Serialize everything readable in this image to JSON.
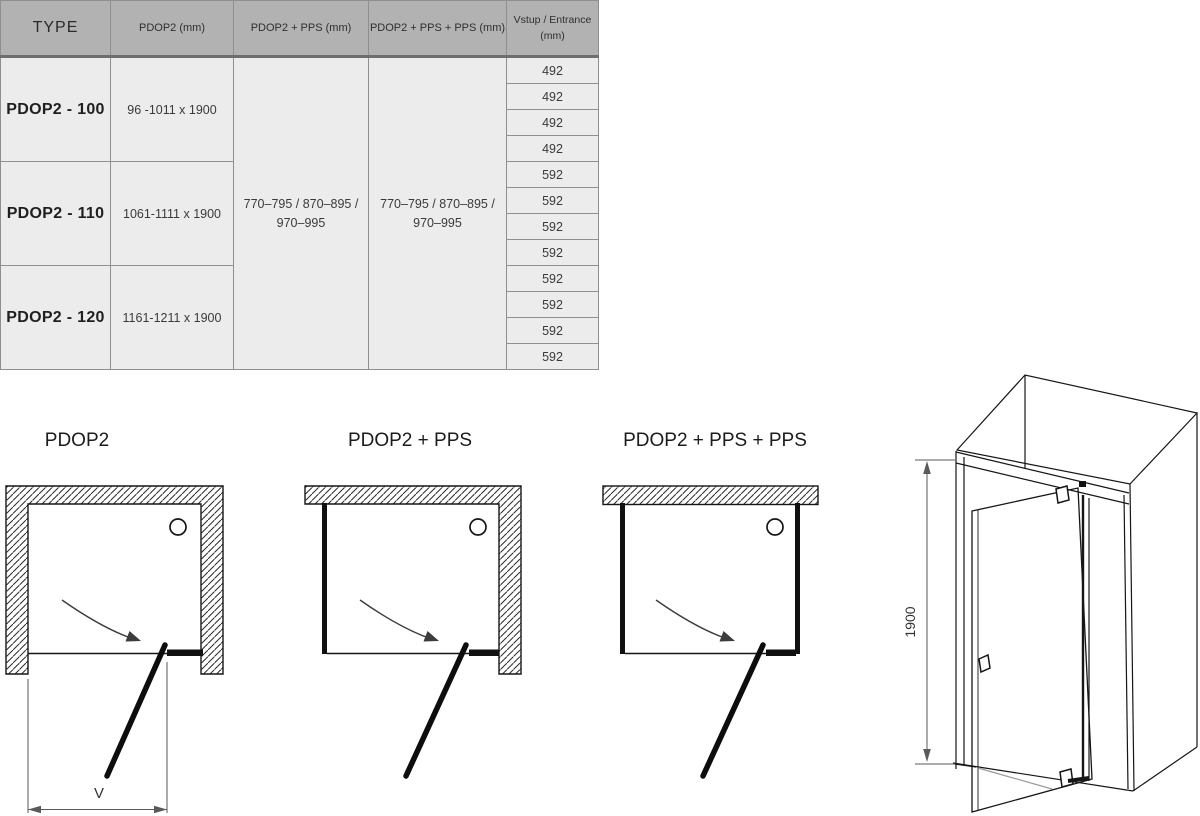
{
  "colors": {
    "header_bg": "#b2b2b2",
    "cell_bg": "#ececec",
    "grid_line": "#8f8f8f",
    "header_rule": "#6e6e6e",
    "ink": "#161616",
    "dim_line": "#5a5a5a"
  },
  "table": {
    "headers": {
      "type": "TYPE",
      "pdop2": "PDOP2 (mm)",
      "pdop2_pps": "PDOP2 + PPS (mm)",
      "pdop2_pps_pps": "PDOP2 + PPS + PPS (mm)",
      "entrance_line1": "Vstup / Entrance",
      "entrance_line2": "(mm)"
    },
    "rows": [
      {
        "type": "PDOP2 - 100",
        "size": "96 -1011 x 1900",
        "entrance": [
          "492",
          "492",
          "492",
          "492"
        ]
      },
      {
        "type": "PDOP2 - 110",
        "size": "1061-1111 x 1900",
        "entrance": [
          "592",
          "592",
          "592",
          "592"
        ]
      },
      {
        "type": "PDOP2 - 120",
        "size": "1161-1211 x 1900",
        "entrance": [
          "592",
          "592",
          "592",
          "592"
        ]
      }
    ],
    "pps_cell": {
      "line1": "770–795 / 870–895 /",
      "line2": "970–995"
    },
    "pps_pps_cell": {
      "line1": "770–795 / 870–895 /",
      "line2": "970–995"
    }
  },
  "diagrams": {
    "label_pdop2": "PDOP2",
    "label_pdop2_pps": "PDOP2 + PPS",
    "label_pdop2_pps_pps": "PDOP2 + PPS + PPS",
    "entrance_dim_label": "V"
  },
  "iso_drawing": {
    "height_dim_label": "1900"
  }
}
